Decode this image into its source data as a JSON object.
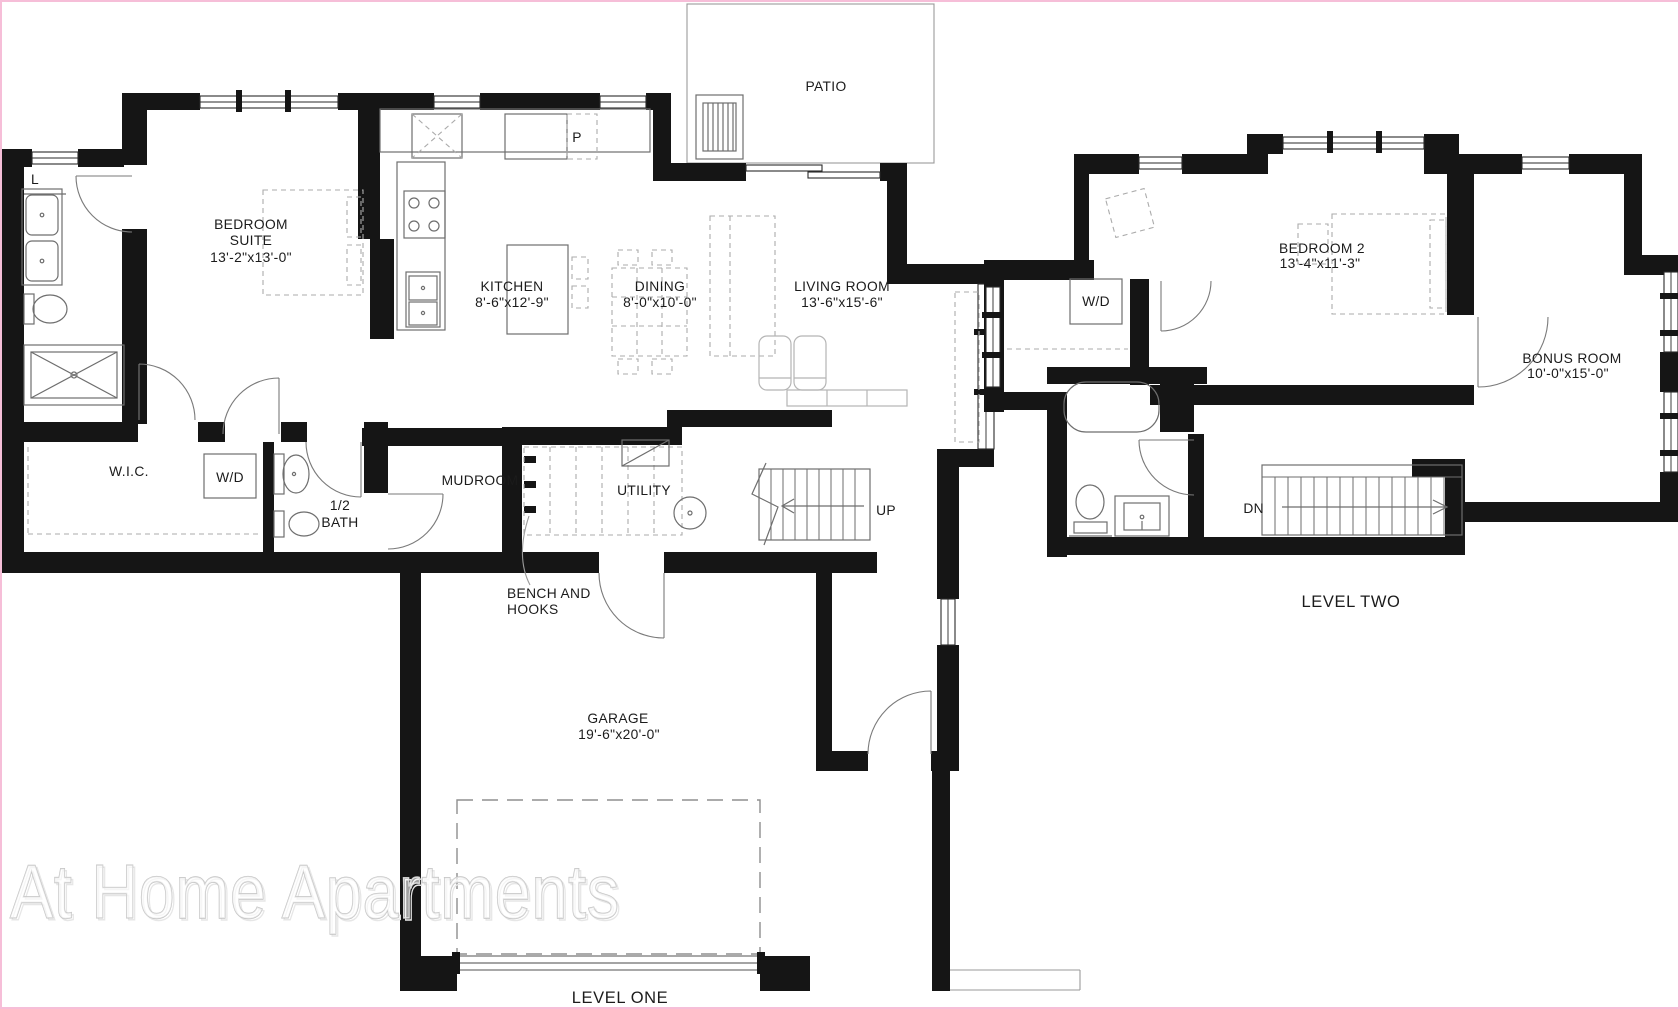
{
  "page": {
    "background": "#ffffff",
    "frame_color": "#f6bed8"
  },
  "colors": {
    "wall": "#151515",
    "line": "#6e6e6e",
    "dashed": "#ababab",
    "text": "#1b1b1b",
    "watermark": "#c3c3c3"
  },
  "watermark": {
    "text": "At Home Apartments"
  },
  "level_one": {
    "caption": "LEVEL ONE",
    "rooms": {
      "patio": "PATIO",
      "bedroom_suite": {
        "name_line1": "BEDROOM",
        "name_line2": "SUITE",
        "dims": "13'-2\"x13'-0\""
      },
      "kitchen": {
        "name": "KITCHEN",
        "dims": "8'-6\"x12'-9\""
      },
      "dining": {
        "name": "DINING",
        "dims": "8'-0\"x10'-0\""
      },
      "living_room": {
        "name": "LIVING ROOM",
        "dims": "13'-6\"x15'-6\""
      },
      "wic": "W.I.C.",
      "washer_dryer": "W/D",
      "half_bath": {
        "line1": "1/2",
        "line2": "BATH"
      },
      "mudroom": "MUDROOM",
      "utility": "UTILITY",
      "garage": {
        "name": "GARAGE",
        "dims": "19'-6\"x20'-0\""
      }
    },
    "annotations": {
      "up": "UP",
      "bench_line1": "BENCH AND",
      "bench_line2": "HOOKS",
      "pantry": "P",
      "linen": "L"
    }
  },
  "level_two": {
    "caption": "LEVEL TWO",
    "rooms": {
      "bedroom_2": {
        "name": "BEDROOM 2",
        "dims": "13'-4\"x11'-3\""
      },
      "bonus_room": {
        "name": "BONUS ROOM",
        "dims": "10'-0\"x15'-0\""
      },
      "washer_dryer": "W/D"
    },
    "annotations": {
      "down": "DN"
    }
  }
}
